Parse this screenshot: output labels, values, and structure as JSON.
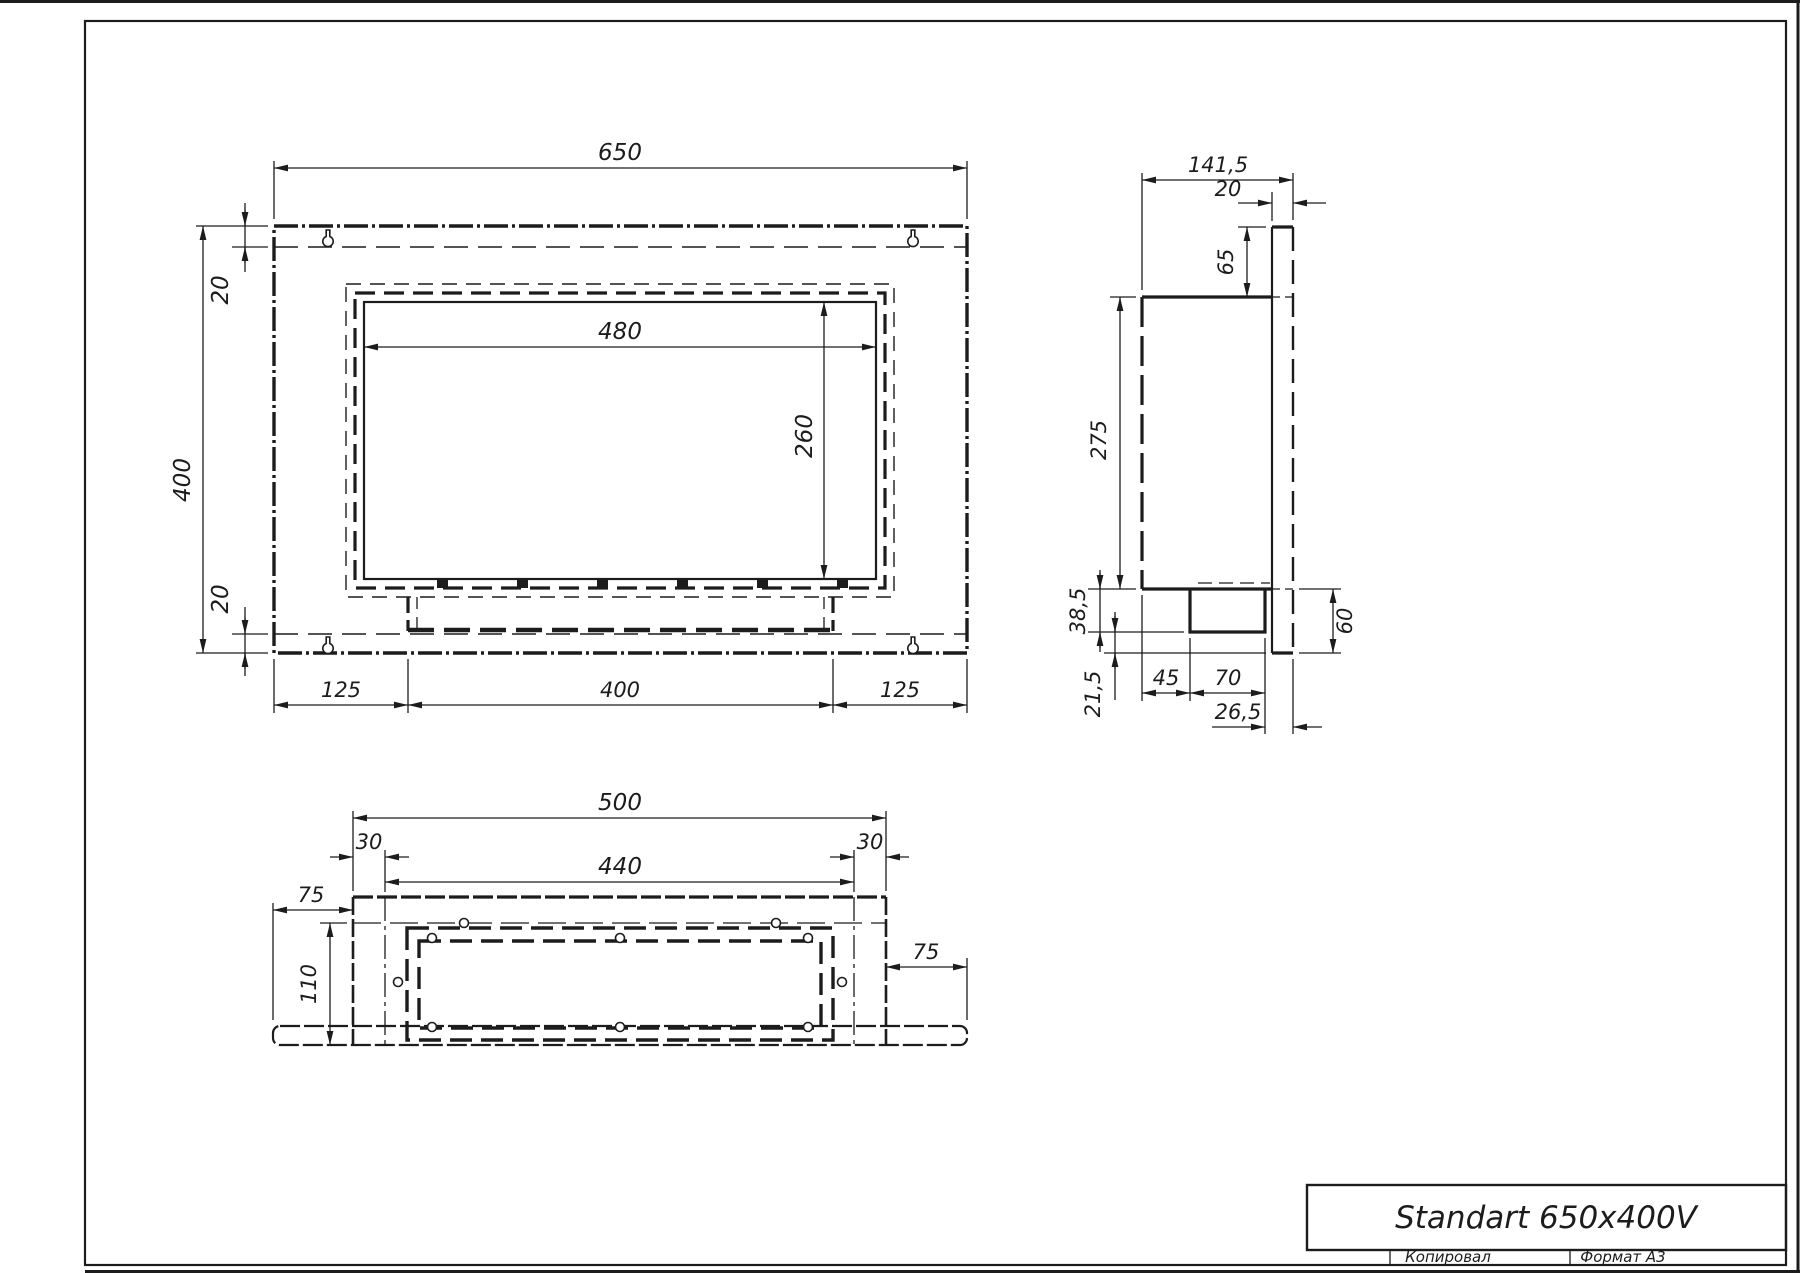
{
  "drawing": {
    "front_view": {
      "width": "650",
      "height": "400",
      "margin_top": "20",
      "margin_bottom": "20",
      "opening_width": "480",
      "opening_height": "260",
      "bottom_left": "125",
      "bottom_center": "400",
      "bottom_right": "125"
    },
    "side_view": {
      "depth": "141,5",
      "flange_thickness": "20",
      "top_offset": "65",
      "body_height": "275",
      "tray_drop": "38,5",
      "tray_gap": "21,5",
      "tray_offset": "45",
      "tray_depth": "70",
      "tray_back": "26,5",
      "flange_bottom": "60"
    },
    "bottom_view": {
      "body_width": "500",
      "inset_left": "30",
      "inner_width": "440",
      "inset_right": "30",
      "flange_left": "75",
      "depth": "110",
      "flange_right": "75"
    },
    "title_block": {
      "model": "Standart 650x400V",
      "copied": "Копировал",
      "format": "Формат А3"
    }
  }
}
